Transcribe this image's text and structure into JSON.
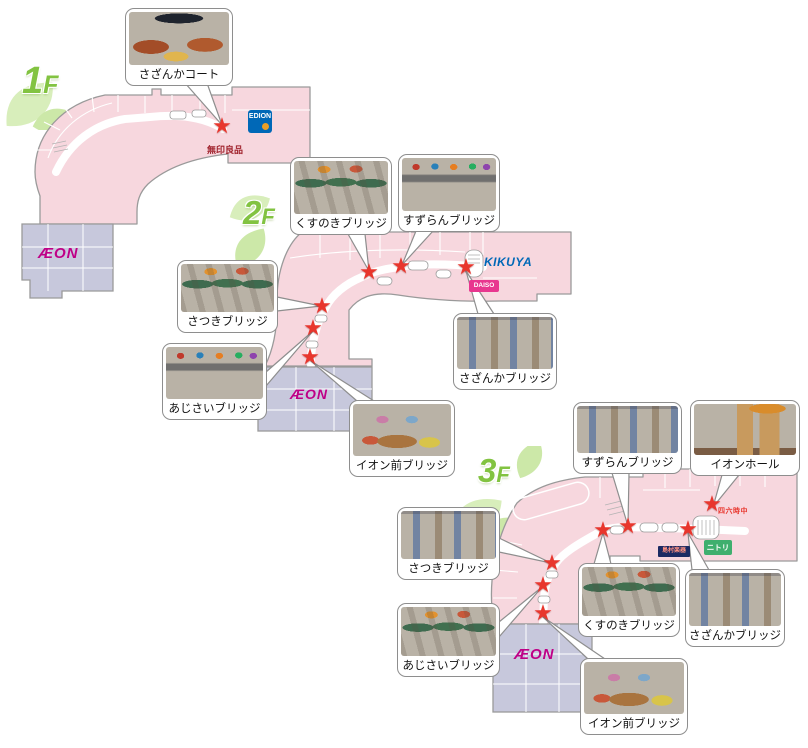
{
  "map": {
    "floors": [
      {
        "id": "1F",
        "num": "1",
        "suffix": "F",
        "aeon_label": "ÆON",
        "tenants": {
          "edion": "EDION",
          "muji": "無印良品"
        },
        "photos": [
          {
            "label": "さざんかコート"
          }
        ]
      },
      {
        "id": "2F",
        "num": "2",
        "suffix": "F",
        "aeon_label": "ÆON",
        "tenants": {
          "kikuya": "KIKUYA",
          "daiso": "DAISO"
        },
        "photos": [
          {
            "label": "くすのきブリッジ"
          },
          {
            "label": "すずらんブリッジ"
          },
          {
            "label": "さつきブリッジ"
          },
          {
            "label": "あじさいブリッジ"
          },
          {
            "label": "さざんかブリッジ"
          },
          {
            "label": "イオン前ブリッジ"
          }
        ]
      },
      {
        "id": "3F",
        "num": "3",
        "suffix": "F",
        "aeon_label": "ÆON",
        "tenants": {
          "nitori": "ニトリ",
          "shimamura_gakki": "島村楽器",
          "restaurant": "四六時中"
        },
        "photos": [
          {
            "label": "さつきブリッジ"
          },
          {
            "label": "すずらんブリッジ"
          },
          {
            "label": "イオンホール"
          },
          {
            "label": "くすのきブリッジ"
          },
          {
            "label": "さざんかブリッジ"
          },
          {
            "label": "あじさいブリッジ"
          },
          {
            "label": "イオン前ブリッジ"
          }
        ]
      }
    ]
  },
  "icons": {
    "star": "★"
  },
  "colors": {
    "plan_pink": "#f7d7de",
    "plan_outline": "#9a9a9a",
    "aeon_block": "#c7c8dc",
    "aeon_magenta": "#bf0087",
    "star_red": "#e8362d",
    "floor_label_green": "#82c341",
    "leaf_green": "#d8eebb",
    "edion_blue": "#0068b7",
    "kikuya_blue": "#0068b7",
    "daiso_pink": "#e8368f",
    "nitori_green": "#3faf6e",
    "shimamura_navy": "#1b2a63",
    "muji_red": "#a0232d"
  }
}
